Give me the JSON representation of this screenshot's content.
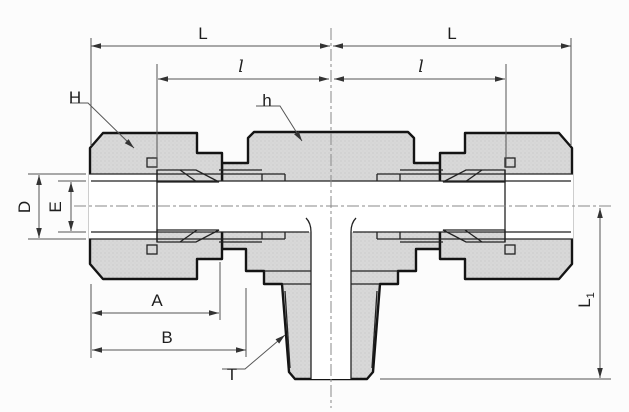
{
  "diagram": {
    "dimension_labels": {
      "L_left": "L",
      "L_right": "L",
      "l_left": "l",
      "l_right": "l",
      "H": "H",
      "h": "h",
      "D": "D",
      "E": "E",
      "A": "A",
      "B": "B",
      "T": "T",
      "L1_main": "L",
      "L1_sub": "1"
    },
    "colors": {
      "outline": "#141414",
      "metal_fill": "#d8d8d8",
      "dimension_lines": "#555555",
      "background": "#fcfcfc"
    }
  }
}
